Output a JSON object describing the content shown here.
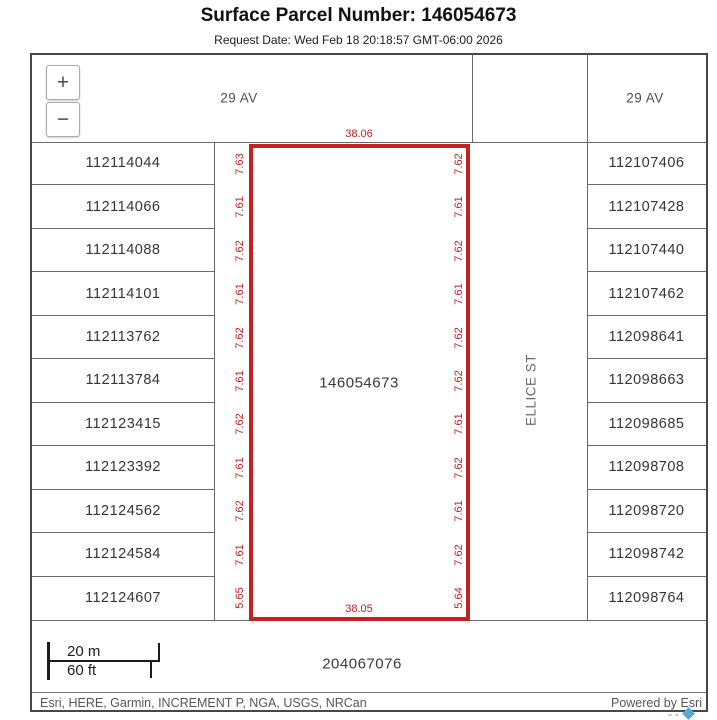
{
  "header": {
    "title": "Surface Parcel Number: 146054673",
    "subtitle": "Request Date: Wed Feb 18 20:18:57 GMT-06:00 2026"
  },
  "map": {
    "zoom_in_label": "+",
    "zoom_out_label": "−",
    "streets": {
      "avenue_left": "29 AV",
      "avenue_right": "29 AV",
      "street_vertical": "ELLICE ST"
    },
    "left_parcels": [
      "112114044",
      "112114066",
      "112114088",
      "112114101",
      "112113762",
      "112113784",
      "112123415",
      "112123392",
      "112124562",
      "112124584",
      "112124607"
    ],
    "right_parcels": [
      "112107406",
      "112107428",
      "112107440",
      "112107462",
      "112098641",
      "112098663",
      "112098685",
      "112098708",
      "112098720",
      "112098742",
      "112098764"
    ],
    "highlight_parcel": {
      "id": "146054673",
      "top_dim": "38.06",
      "bottom_dim": "38.05",
      "left_dims": [
        "7.63",
        "7.61",
        "7.62",
        "7.61",
        "7.62",
        "7.61",
        "7.62",
        "7.61",
        "7.62",
        "7.61",
        "5.65"
      ],
      "right_dims": [
        "7.62",
        "7.61",
        "7.62",
        "7.61",
        "7.62",
        "7.62",
        "7.61",
        "7.62",
        "7.61",
        "7.62",
        "5.64"
      ]
    },
    "bottom_parcel": "204067076",
    "scalebar": {
      "metric": "20 m",
      "imperial": "60 ft"
    }
  },
  "attribution": {
    "sources": "Esri, HERE, Garmin, INCREMENT P, NGA, USGS, NRCan",
    "powered_by": "Powered by Esri"
  },
  "colors": {
    "highlight_red": "#c42121",
    "grid_gray": "#6a6a6a"
  }
}
